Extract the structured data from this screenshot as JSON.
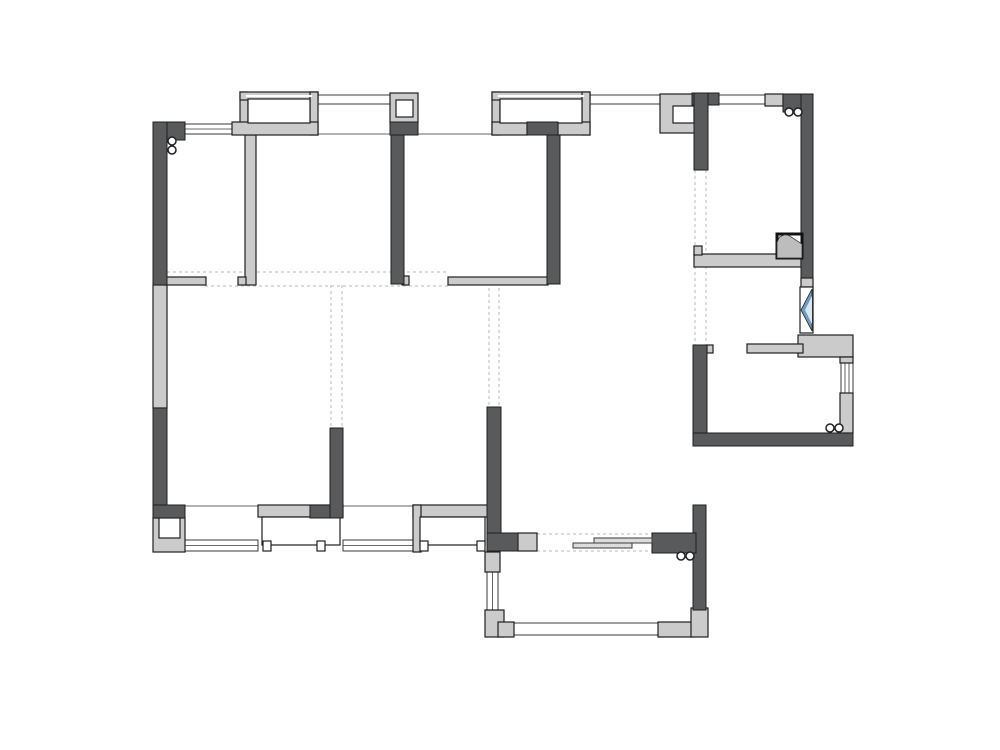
{
  "canvas": {
    "width": 1000,
    "height": 750,
    "background": "#ffffff"
  },
  "palette": {
    "wall_dark": "#595a5c",
    "wall_light": "#cbcbcb",
    "outline": "#1f1f1f",
    "window_line": "#3a3a3a",
    "thin_line": "#9a9a9a",
    "dashed": "#c6c6c6",
    "door_bar": "#dcdcdc",
    "glass_dark": "#6d9bc3",
    "glass_light": "#d8e6f2",
    "flue_fill": "#bdbdbd",
    "white": "#ffffff"
  },
  "floorplan": {
    "dark_walls": [
      {
        "name": "wall-top-left-corner",
        "x": 153,
        "y": 122,
        "w": 32,
        "h": 18
      },
      {
        "name": "wall-left-upper",
        "x": 153,
        "y": 122,
        "w": 14,
        "h": 163
      },
      {
        "name": "wall-left-lower",
        "x": 153,
        "y": 408,
        "w": 14,
        "h": 110
      },
      {
        "name": "wall-bottom-left-corner",
        "x": 153,
        "y": 505,
        "w": 32,
        "h": 13
      },
      {
        "name": "wall-bed2-bed3",
        "x": 391,
        "y": 135,
        "w": 13,
        "h": 149
      },
      {
        "name": "column3-base",
        "x": 390,
        "y": 122,
        "w": 28,
        "h": 13
      },
      {
        "name": "bay2-base-dark-segment",
        "x": 527,
        "y": 122,
        "w": 31,
        "h": 13
      },
      {
        "name": "wall-bed3-right",
        "x": 547,
        "y": 135,
        "w": 13,
        "h": 149
      },
      {
        "name": "bay4-top-dark-segment",
        "x": 310,
        "y": 505,
        "w": 33,
        "h": 13
      },
      {
        "name": "wall-above-bay4",
        "x": 330,
        "y": 428,
        "w": 13,
        "h": 90
      },
      {
        "name": "wall-center-vertical",
        "x": 487,
        "y": 407,
        "w": 14,
        "h": 128
      },
      {
        "name": "wall-center-foot",
        "x": 487,
        "y": 533,
        "w": 31,
        "h": 18
      },
      {
        "name": "column4-cap",
        "x": 692,
        "y": 93,
        "w": 27,
        "h": 12
      },
      {
        "name": "wall-entry-top",
        "x": 694,
        "y": 93,
        "w": 14,
        "h": 77
      },
      {
        "name": "wall-top-right-corner",
        "x": 783,
        "y": 94,
        "w": 30,
        "h": 18
      },
      {
        "name": "wall-right-upper",
        "x": 801,
        "y": 94,
        "w": 12,
        "h": 184
      },
      {
        "name": "wall-kitchen-left",
        "x": 693,
        "y": 345,
        "w": 14,
        "h": 101
      },
      {
        "name": "wall-kitchen-bottom",
        "x": 693,
        "y": 433,
        "w": 160,
        "h": 13
      },
      {
        "name": "wall-right-lower-vertical",
        "x": 693,
        "y": 505,
        "w": 13,
        "h": 105
      },
      {
        "name": "wall-right-lower-horizontal",
        "x": 652,
        "y": 533,
        "w": 44,
        "h": 20
      }
    ],
    "light_walls": [
      {
        "name": "wall-left-middle",
        "x": 153,
        "y": 285,
        "w": 14,
        "h": 123
      },
      {
        "name": "wall-bed1-bed2",
        "x": 245,
        "y": 135,
        "w": 11,
        "h": 150
      },
      {
        "name": "wall-bed1-bed2-foot",
        "x": 238,
        "y": 277,
        "w": 8,
        "h": 8
      },
      {
        "name": "stub-wall-bed1",
        "x": 165,
        "y": 277,
        "w": 41,
        "h": 8
      },
      {
        "name": "bay1-left-frame",
        "x": 240,
        "y": 92,
        "w": 8,
        "h": 33
      },
      {
        "name": "bay1-top-frame",
        "x": 240,
        "y": 92,
        "w": 78,
        "h": 8
      },
      {
        "name": "bay1-right-frame",
        "x": 310,
        "y": 92,
        "w": 8,
        "h": 43
      },
      {
        "name": "bay1-sill",
        "x": 232,
        "y": 122,
        "w": 86,
        "h": 13
      },
      {
        "name": "column3-frame",
        "x": 390,
        "y": 93,
        "w": 28,
        "h": 30
      },
      {
        "name": "bay2-left-frame",
        "x": 492,
        "y": 92,
        "w": 8,
        "h": 43
      },
      {
        "name": "bay2-top-frame",
        "x": 492,
        "y": 92,
        "w": 98,
        "h": 8
      },
      {
        "name": "bay2-right-frame",
        "x": 582,
        "y": 92,
        "w": 8,
        "h": 43
      },
      {
        "name": "bay2-sill-left",
        "x": 492,
        "y": 122,
        "w": 35,
        "h": 13
      },
      {
        "name": "bay2-sill-right",
        "x": 558,
        "y": 122,
        "w": 32,
        "h": 13
      },
      {
        "name": "column4-frame",
        "x": 660,
        "y": 94,
        "w": 35,
        "h": 39
      },
      {
        "name": "block-top-right",
        "x": 765,
        "y": 94,
        "w": 18,
        "h": 12
      },
      {
        "name": "block-right-wall",
        "x": 801,
        "y": 278,
        "w": 12,
        "h": 9
      },
      {
        "name": "wall-step-out",
        "x": 798,
        "y": 335,
        "w": 55,
        "h": 22
      },
      {
        "name": "block-right-window-top",
        "x": 840,
        "y": 357,
        "w": 13,
        "h": 6
      },
      {
        "name": "wall-right-window-bottom",
        "x": 840,
        "y": 393,
        "w": 13,
        "h": 40
      },
      {
        "name": "counter-upper",
        "x": 694,
        "y": 254,
        "w": 107,
        "h": 13
      },
      {
        "name": "counter-upper-stub",
        "x": 694,
        "y": 246,
        "w": 8,
        "h": 9
      },
      {
        "name": "counter-lower",
        "x": 747,
        "y": 344,
        "w": 56,
        "h": 9
      },
      {
        "name": "kitchen-wall-notch",
        "x": 707,
        "y": 345,
        "w": 6,
        "h": 8
      },
      {
        "name": "sill-bed3",
        "x": 448,
        "y": 277,
        "w": 100,
        "h": 8
      },
      {
        "name": "sill-foot-bed3",
        "x": 402,
        "y": 276,
        "w": 7,
        "h": 9
      },
      {
        "name": "bay4-top-frame",
        "x": 258,
        "y": 505,
        "w": 85,
        "h": 12
      },
      {
        "name": "bay3-top-frame",
        "x": 413,
        "y": 505,
        "w": 75,
        "h": 12
      },
      {
        "name": "bay3-left-frame",
        "x": 413,
        "y": 505,
        "w": 8,
        "h": 47
      },
      {
        "name": "block-bottom-left",
        "x": 153,
        "y": 518,
        "w": 32,
        "h": 34
      },
      {
        "name": "block-center-foot",
        "x": 518,
        "y": 533,
        "w": 19,
        "h": 18
      },
      {
        "name": "balcony-top-left-block",
        "x": 485,
        "y": 552,
        "w": 15,
        "h": 20
      },
      {
        "name": "balcony-bottom-left-block",
        "x": 485,
        "y": 610,
        "w": 19,
        "h": 27
      },
      {
        "name": "balcony-bottom-left-step",
        "x": 498,
        "y": 622,
        "w": 16,
        "h": 15
      },
      {
        "name": "balcony-bottom-right-block",
        "x": 658,
        "y": 622,
        "w": 35,
        "h": 15
      },
      {
        "name": "balcony-right-block",
        "x": 691,
        "y": 608,
        "w": 17,
        "h": 29
      }
    ],
    "white_boxes": [
      {
        "name": "bay1-glазing-area",
        "x": 248,
        "y": 99,
        "w": 62,
        "h": 24
      },
      {
        "name": "bay2-glazing-area",
        "x": 500,
        "y": 99,
        "w": 82,
        "h": 24
      },
      {
        "name": "column3-inner",
        "x": 396,
        "y": 100,
        "w": 17,
        "h": 17
      },
      {
        "name": "column4-inner",
        "x": 673,
        "y": 106,
        "w": 21,
        "h": 17
      },
      {
        "name": "block-bottom-left-inner",
        "x": 159,
        "y": 518,
        "w": 21,
        "h": 20
      },
      {
        "name": "bay4-box",
        "x": 262,
        "y": 517,
        "w": 78,
        "h": 28
      },
      {
        "name": "bay4-foot-left",
        "x": 263,
        "y": 541,
        "w": 8,
        "h": 10
      },
      {
        "name": "bay4-foot-right",
        "x": 317,
        "y": 541,
        "w": 8,
        "h": 10
      },
      {
        "name": "bay3-box",
        "x": 420,
        "y": 517,
        "w": 65,
        "h": 28
      },
      {
        "name": "bay3-foot-left",
        "x": 420,
        "y": 541,
        "w": 8,
        "h": 10
      },
      {
        "name": "bay3-foot-right",
        "x": 477,
        "y": 541,
        "w": 8,
        "h": 10
      }
    ],
    "h_windows": [
      {
        "name": "window-top-left",
        "x": 185,
        "y": 124,
        "w": 48,
        "h": 10,
        "mid": true
      },
      {
        "name": "window-band-1",
        "x": 318,
        "y": 95,
        "w": 72,
        "h": 9,
        "mid": false
      },
      {
        "name": "window-band-2",
        "x": 590,
        "y": 95,
        "w": 72,
        "h": 9,
        "mid": false
      },
      {
        "name": "window-band-3",
        "x": 719,
        "y": 95,
        "w": 46,
        "h": 9,
        "mid": false
      },
      {
        "name": "window-bottom-left",
        "x": 185,
        "y": 540,
        "w": 73,
        "h": 11,
        "mid": true
      },
      {
        "name": "window-bottom-mid",
        "x": 343,
        "y": 540,
        "w": 70,
        "h": 11,
        "mid": true
      },
      {
        "name": "window-balcony-bottom",
        "x": 514,
        "y": 623,
        "w": 146,
        "h": 12,
        "mid": false
      }
    ],
    "v_windows": [
      {
        "name": "window-balcony-left",
        "x": 487,
        "y": 572,
        "w": 11,
        "h": 40,
        "mids": 1
      },
      {
        "name": "window-right-side",
        "x": 841,
        "y": 363,
        "w": 12,
        "h": 30,
        "mids": 2
      }
    ],
    "thin_lines": [
      {
        "name": "wall-line-top-1",
        "x1": 318,
        "y1": 134,
        "x2": 391,
        "y2": 134
      },
      {
        "name": "wall-line-top-2",
        "x1": 418,
        "y1": 134,
        "x2": 492,
        "y2": 134
      },
      {
        "name": "wall-line-bottom-1",
        "x1": 185,
        "y1": 506,
        "x2": 258,
        "y2": 506
      },
      {
        "name": "wall-line-bottom-2",
        "x1": 343,
        "y1": 506,
        "x2": 413,
        "y2": 506
      }
    ],
    "dashed_lines": [
      {
        "name": "dash-corridor-top",
        "x1": 167,
        "y1": 272,
        "x2": 448,
        "y2": 272
      },
      {
        "name": "dash-corridor-bottom",
        "x1": 205,
        "y1": 286,
        "x2": 448,
        "y2": 286
      },
      {
        "name": "dash-wall-330-a",
        "x1": 331,
        "y1": 285,
        "x2": 331,
        "y2": 428
      },
      {
        "name": "dash-wall-330-b",
        "x1": 342,
        "y1": 285,
        "x2": 342,
        "y2": 428
      },
      {
        "name": "dash-wall-488-a",
        "x1": 489,
        "y1": 288,
        "x2": 489,
        "y2": 407
      },
      {
        "name": "dash-wall-488-b",
        "x1": 499,
        "y1": 288,
        "x2": 499,
        "y2": 407
      },
      {
        "name": "dash-wall-694-a",
        "x1": 695,
        "y1": 170,
        "x2": 695,
        "y2": 345
      },
      {
        "name": "dash-wall-694-b",
        "x1": 706,
        "y1": 170,
        "x2": 706,
        "y2": 345
      },
      {
        "name": "dash-opening-top",
        "x1": 537,
        "y1": 534,
        "x2": 652,
        "y2": 534
      },
      {
        "name": "dash-opening-bottom",
        "x1": 537,
        "y1": 551,
        "x2": 652,
        "y2": 551
      }
    ],
    "white_lines": [
      {
        "name": "bay1-glass-line",
        "x1": 246,
        "y1": 96,
        "x2": 312,
        "y2": 96
      },
      {
        "name": "bay2-glass-line",
        "x1": 498,
        "y1": 96,
        "x2": 584,
        "y2": 96
      }
    ],
    "door_bars": [
      {
        "name": "sliding-door-leaf-1",
        "x": 594,
        "y": 538,
        "w": 58,
        "h": 5
      },
      {
        "name": "sliding-door-leaf-2",
        "x": 573,
        "y": 543,
        "w": 59,
        "h": 5
      }
    ],
    "circles": [
      {
        "name": "marker-top-left-a",
        "cx": 172,
        "cy": 141,
        "r": 4
      },
      {
        "name": "marker-top-left-b",
        "cx": 172,
        "cy": 150,
        "r": 4
      },
      {
        "name": "marker-top-right-a",
        "cx": 789,
        "cy": 112,
        "r": 4
      },
      {
        "name": "marker-top-right-b",
        "cx": 798,
        "cy": 112,
        "r": 4
      },
      {
        "name": "marker-kitchen-a",
        "cx": 830,
        "cy": 428,
        "r": 4
      },
      {
        "name": "marker-kitchen-b",
        "cx": 839,
        "cy": 428,
        "r": 4
      },
      {
        "name": "marker-balcony-a",
        "cx": 681,
        "cy": 556,
        "r": 4
      },
      {
        "name": "marker-balcony-b",
        "cx": 690,
        "cy": 556,
        "r": 4
      }
    ],
    "flue": {
      "name": "flue-shaft-symbol",
      "x": 777,
      "y": 234,
      "w": 25,
      "h": 24
    },
    "glass": {
      "name": "casement-window-symbol",
      "x": 800,
      "y": 287,
      "w": 13,
      "h": 46
    }
  }
}
